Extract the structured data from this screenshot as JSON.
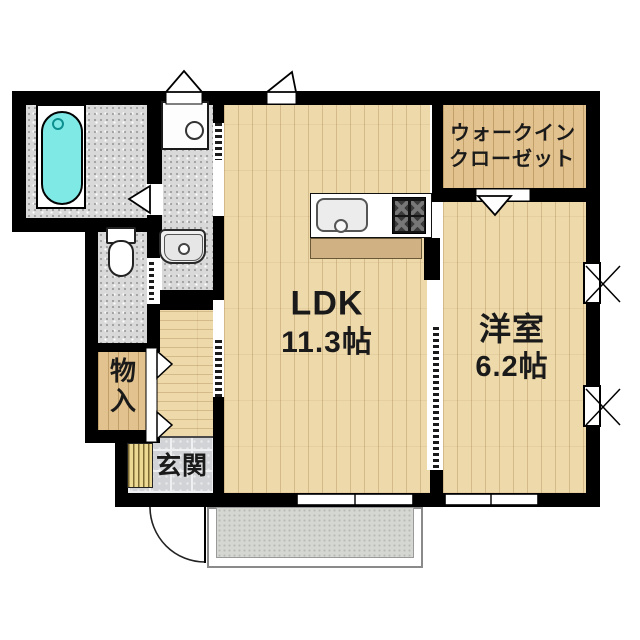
{
  "rooms": {
    "ldk": {
      "label": "LDK",
      "area": "11.3帖"
    },
    "western_room": {
      "label": "洋室",
      "area": "6.2帖"
    },
    "walk_in_closet": {
      "label_line1": "ウォークイン",
      "label_line2": "クローゼット"
    },
    "storage": {
      "label": "物入"
    },
    "entrance": {
      "label": "玄関"
    }
  },
  "fixtures": [
    "bathtub",
    "toilet",
    "washbasin",
    "washing-machine-pan",
    "kitchen-sink",
    "gas-stove",
    "kitchen-counter",
    "shoe-cabinet",
    "entrance-door-swing",
    "sliding-doors",
    "sliding-windows",
    "casement-windows",
    "balcony"
  ],
  "colors": {
    "wall": "#000000",
    "wood-light": "#eed9ab",
    "wood-tan": "#e2c28e",
    "gray-floor": "#d9d9d9",
    "tile": "#d2d3d6",
    "balcony": "#d5d7d3",
    "tub": "#7fe9e6",
    "cabinet": "#cfb184",
    "shoe": "#ecd993"
  }
}
